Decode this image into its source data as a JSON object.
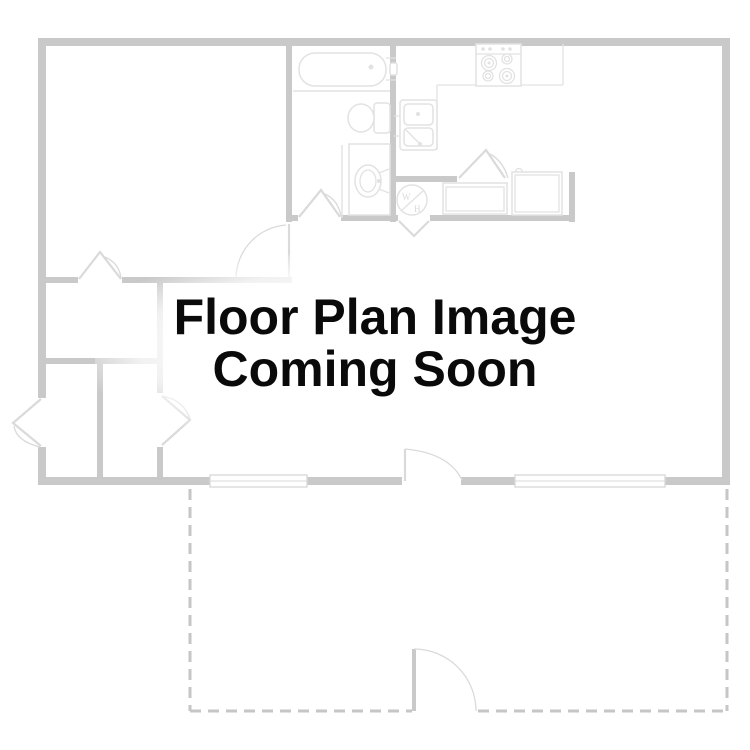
{
  "placeholder": {
    "line1": "Floor Plan Image",
    "line2": "Coming Soon"
  },
  "floor_plan": {
    "water_heater_label_top": "W",
    "water_heater_label_bottom": "H"
  },
  "colors": {
    "background": "#ffffff",
    "wall": "#c9c9c9",
    "wall_light": "#dadada",
    "fixture": "#e2e2e2",
    "dashed_outline": "#c6c6c6",
    "text": "#0a0a0a"
  }
}
